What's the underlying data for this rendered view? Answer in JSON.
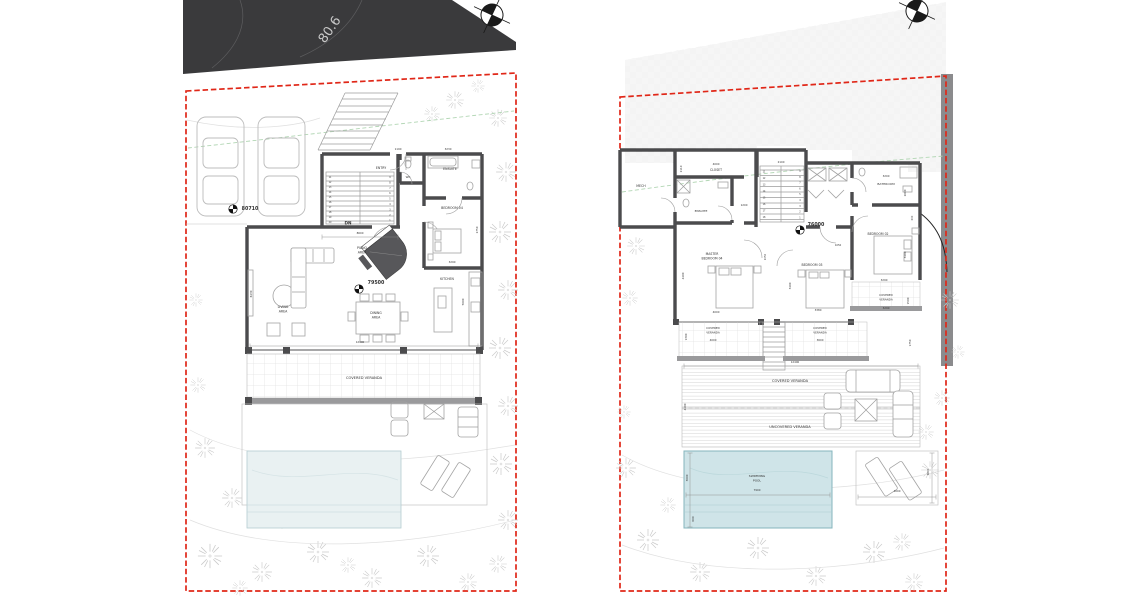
{
  "meta": {
    "road_label": "80.6"
  },
  "colors": {
    "boundary": "#e02718",
    "wall": "#4b4b4d",
    "road": "#3a3a3c",
    "pool_right": "#cfe4e8",
    "pool_left": "#e9f1f2",
    "green_contour": "#b2d6b4",
    "retaining_band": "#8b8b8d"
  },
  "left_plan": {
    "stairs": {
      "down_label": "DN",
      "treads_left": [
        "11",
        "12",
        "13",
        "14",
        "15",
        "16",
        "17",
        "18",
        "19",
        "20"
      ],
      "treads_right": [
        "9",
        "8",
        "7",
        "6",
        "5",
        "4",
        "3",
        "2",
        "1"
      ]
    },
    "labels": [
      {
        "t": "ENTRY",
        "x": 381,
        "y": 169,
        "s": 3.2
      },
      {
        "t": "WC",
        "x": 408,
        "y": 178,
        "s": 2.8
      },
      {
        "t": "ENSUITE",
        "x": 450,
        "y": 170,
        "s": 3.2
      },
      {
        "t": "BEDROOM 04",
        "x": 452,
        "y": 209,
        "s": 3.2
      },
      {
        "t": "1190",
        "x": 398,
        "y": 150,
        "s": 2.7
      },
      {
        "t": "3230",
        "x": 448,
        "y": 150,
        "s": 2.7
      },
      {
        "t": "2750",
        "x": 478,
        "y": 230,
        "s": 2.7,
        "r": -90
      },
      {
        "t": "3290",
        "x": 452,
        "y": 263,
        "s": 2.7
      },
      {
        "t": "PIANO",
        "x": 362,
        "y": 249,
        "s": 3.2
      },
      {
        "t": "AREA",
        "x": 362,
        "y": 253.5,
        "s": 3.2
      },
      {
        "t": "79500",
        "x": 376,
        "y": 284,
        "s": 4.8,
        "b": 1
      },
      {
        "t": "80710",
        "x": 250,
        "y": 210,
        "s": 4.8,
        "b": 1
      },
      {
        "t": "LIVING",
        "x": 283,
        "y": 308,
        "s": 3.2
      },
      {
        "t": "AREA",
        "x": 283,
        "y": 312.5,
        "s": 3.2
      },
      {
        "t": "DINING",
        "x": 376,
        "y": 314,
        "s": 3.2
      },
      {
        "t": "AREA",
        "x": 376,
        "y": 318.5,
        "s": 3.2
      },
      {
        "t": "KITCHEN",
        "x": 447,
        "y": 280,
        "s": 3.2
      },
      {
        "t": "6430",
        "x": 252,
        "y": 294,
        "s": 2.7,
        "r": -90
      },
      {
        "t": "5000",
        "x": 464,
        "y": 302,
        "s": 2.7,
        "r": -90
      },
      {
        "t": "8600",
        "x": 360,
        "y": 234,
        "s": 2.7
      },
      {
        "t": "12400",
        "x": 360,
        "y": 343,
        "s": 2.7
      },
      {
        "t": "COVERED VERANDA",
        "x": 364,
        "y": 379,
        "s": 3.6
      },
      {
        "t": "DN",
        "x": 348,
        "y": 224.5,
        "s": 4.2,
        "b": 1
      }
    ]
  },
  "right_plan": {
    "stairs": {
      "treads_left": [
        "11",
        "12",
        "13",
        "14",
        "15",
        "16",
        "17",
        "18"
      ],
      "treads_right": [
        "9",
        "8",
        "7",
        "6",
        "5",
        "4",
        "3",
        "2",
        "1"
      ]
    },
    "labels": [
      {
        "t": "MECH",
        "x": 641,
        "y": 187,
        "s": 3.2
      },
      {
        "t": "CLOSET",
        "x": 716,
        "y": 171,
        "s": 3.1
      },
      {
        "t": "4000",
        "x": 716,
        "y": 165,
        "s": 2.7
      },
      {
        "t": "2110",
        "x": 682,
        "y": 169,
        "s": 2.7,
        "r": -90
      },
      {
        "t": "ENSUITE",
        "x": 701,
        "y": 212,
        "s": 3
      },
      {
        "t": "1200",
        "x": 744,
        "y": 206,
        "s": 2.7
      },
      {
        "t": "2100",
        "x": 781,
        "y": 163,
        "s": 2.7
      },
      {
        "t": "BATHROOM",
        "x": 886,
        "y": 185,
        "s": 3
      },
      {
        "t": "3200",
        "x": 886,
        "y": 177,
        "s": 2.7
      },
      {
        "t": "2000",
        "x": 906,
        "y": 193,
        "s": 2.7,
        "r": -90
      },
      {
        "t": "76000",
        "x": 816,
        "y": 226,
        "s": 4.8,
        "b": 1
      },
      {
        "t": "MASTER",
        "x": 712,
        "y": 255,
        "s": 3.1
      },
      {
        "t": "BEDROOM 04",
        "x": 712,
        "y": 259.5,
        "s": 3.1
      },
      {
        "t": "4400",
        "x": 684,
        "y": 276,
        "s": 2.7,
        "r": -90
      },
      {
        "t": "4000",
        "x": 716,
        "y": 313,
        "s": 2.7
      },
      {
        "t": "BEDROOM 03",
        "x": 812,
        "y": 266,
        "s": 3.1
      },
      {
        "t": "3400",
        "x": 791,
        "y": 286,
        "s": 2.7,
        "r": -90
      },
      {
        "t": "3380",
        "x": 818,
        "y": 311,
        "s": 2.7
      },
      {
        "t": "BEDROOM 02",
        "x": 878,
        "y": 235,
        "s": 3.1
      },
      {
        "t": "3290",
        "x": 884,
        "y": 281,
        "s": 2.7
      },
      {
        "t": "3400",
        "x": 906,
        "y": 255,
        "s": 2.7,
        "r": -90
      },
      {
        "t": "1050",
        "x": 766,
        "y": 257,
        "s": 2.5,
        "r": -90
      },
      {
        "t": "1050",
        "x": 838,
        "y": 246,
        "s": 2.5
      },
      {
        "t": "600",
        "x": 913,
        "y": 218,
        "s": 2.5,
        "r": -90
      },
      {
        "t": "COVERED",
        "x": 886,
        "y": 296,
        "s": 2.8
      },
      {
        "t": "VERANDA",
        "x": 886,
        "y": 300.5,
        "s": 2.8
      },
      {
        "t": "3290",
        "x": 886,
        "y": 309,
        "s": 2.7
      },
      {
        "t": "1500",
        "x": 909,
        "y": 301,
        "s": 2.7,
        "r": -90
      },
      {
        "t": "COVERED",
        "x": 713,
        "y": 329,
        "s": 2.8
      },
      {
        "t": "VERANDA",
        "x": 713,
        "y": 333.5,
        "s": 2.8
      },
      {
        "t": "4000",
        "x": 713,
        "y": 341,
        "s": 2.7
      },
      {
        "t": "1300",
        "x": 687,
        "y": 337,
        "s": 2.7,
        "r": -90
      },
      {
        "t": "COVERED",
        "x": 820,
        "y": 329,
        "s": 2.8
      },
      {
        "t": "VERANDA",
        "x": 820,
        "y": 333.5,
        "s": 2.8
      },
      {
        "t": "3600",
        "x": 820,
        "y": 341,
        "s": 2.7
      },
      {
        "t": "1750",
        "x": 911,
        "y": 343,
        "s": 2.7,
        "r": -90
      },
      {
        "t": "12400",
        "x": 795,
        "y": 363,
        "s": 2.7
      },
      {
        "t": "COVERED VERANDA",
        "x": 790,
        "y": 382,
        "s": 3.6
      },
      {
        "t": "4400",
        "x": 686,
        "y": 407,
        "s": 2.7,
        "r": -90
      },
      {
        "t": "UNCOVERED VERANDA",
        "x": 790,
        "y": 428,
        "s": 3.6
      },
      {
        "t": "SWIMMING",
        "x": 757,
        "y": 477,
        "s": 3
      },
      {
        "t": "POOL",
        "x": 757,
        "y": 481.5,
        "s": 3
      },
      {
        "t": "7900",
        "x": 757,
        "y": 491,
        "s": 2.7
      },
      {
        "t": "3000",
        "x": 688,
        "y": 478,
        "s": 2.7,
        "r": -90
      },
      {
        "t": "600",
        "x": 694,
        "y": 519,
        "s": 2.7,
        "r": -90
      },
      {
        "t": "4000",
        "x": 897,
        "y": 492,
        "s": 2.7
      },
      {
        "t": "2800",
        "x": 929,
        "y": 472,
        "s": 2.7,
        "r": -90
      }
    ]
  }
}
